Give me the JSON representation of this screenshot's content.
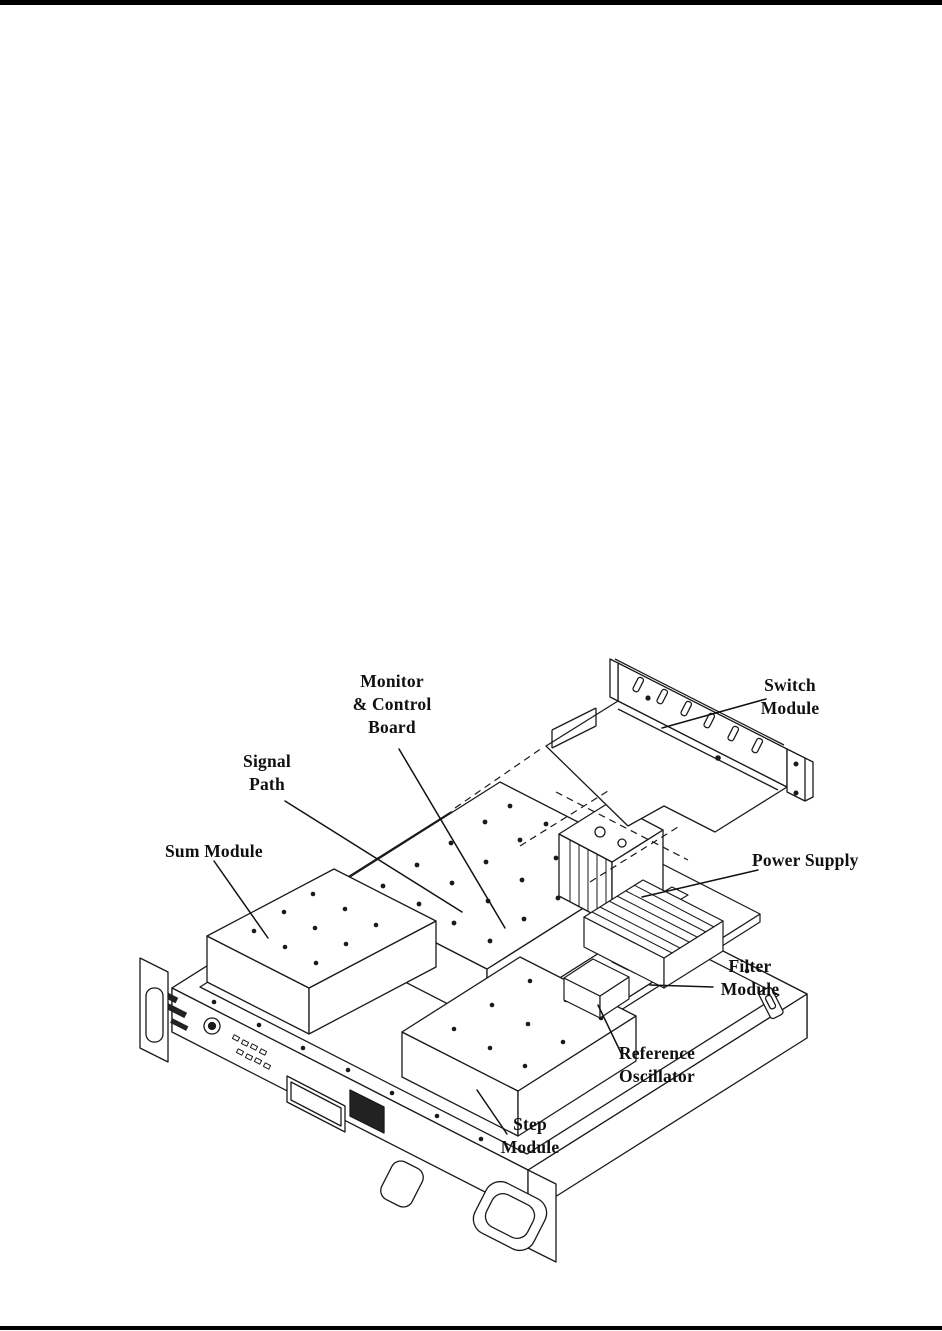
{
  "page": {
    "kind": "manual-figure-page"
  },
  "rules": {
    "top_color": "#000000",
    "bottom_color": "#000000"
  },
  "figure": {
    "ink": "#1a1a1a",
    "description": "Exploded isometric line drawing of 1U rack chassis interior",
    "labels": {
      "monitor_control_board": "Monitor\n& Control\nBoard",
      "switch_module": "Switch\nModule",
      "signal_path": "Signal\nPath",
      "sum_module": "Sum Module",
      "power_supply": "Power Supply",
      "filter_module": "Filter\nModule",
      "reference_oscillator": "Reference\nOscillator",
      "step_module": "Step\nModule"
    }
  }
}
